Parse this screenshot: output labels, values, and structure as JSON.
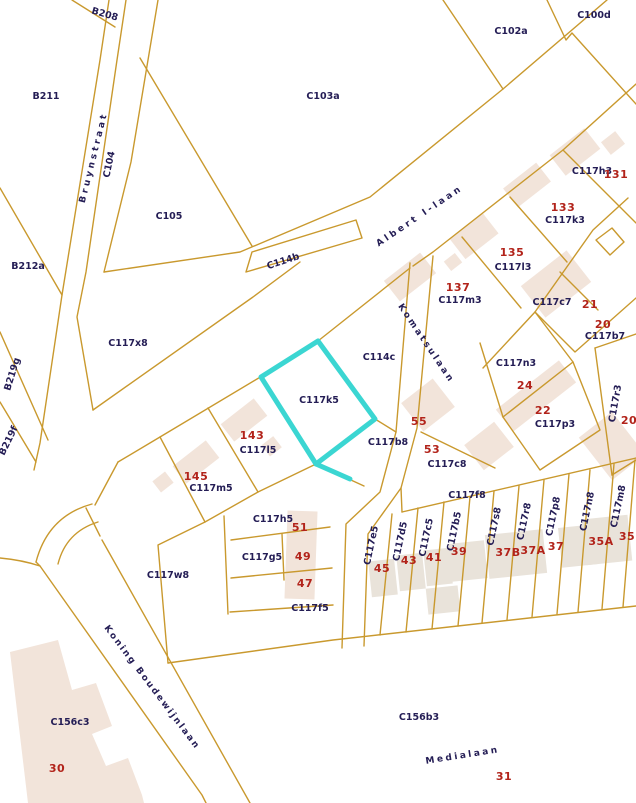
{
  "map": {
    "background": "#ffffff",
    "boundary_color": "#c9992e",
    "building_color": "#f2e4da",
    "parcel_text_color": "#241d55",
    "house_number_color": "#b2231a",
    "highlight": {
      "parcel_code": "C117k5",
      "color": "#3bd6d2"
    },
    "streets": [
      {
        "name": "Bruynstraat",
        "x": 96,
        "y": 158,
        "rot": -76,
        "ls": 3
      },
      {
        "name": "Albert I-laan",
        "x": 421,
        "y": 218,
        "rot": -34,
        "ls": 3
      },
      {
        "name": "Komatsulaan",
        "x": 424,
        "y": 345,
        "rot": 56,
        "ls": 2.5
      },
      {
        "name": "Koning Boudewijnlaan",
        "x": 150,
        "y": 689,
        "rot": 53,
        "ls": 2
      },
      {
        "name": "Medialaan",
        "x": 463,
        "y": 758,
        "rot": -9,
        "ls": 2.5
      }
    ],
    "parcels": [
      {
        "code": "B208",
        "x": 104,
        "y": 17,
        "rot": 16
      },
      {
        "code": "B211",
        "x": 46,
        "y": 99
      },
      {
        "code": "B212a",
        "x": 28,
        "y": 269
      },
      {
        "code": "B219g",
        "x": 15,
        "y": 375,
        "rot": -73
      },
      {
        "code": "B219f",
        "x": 11,
        "y": 442,
        "rot": -64
      },
      {
        "code": "C104",
        "x": 112,
        "y": 165,
        "rot": -78
      },
      {
        "code": "C105",
        "x": 169,
        "y": 219
      },
      {
        "code": "C103a",
        "x": 323,
        "y": 99
      },
      {
        "code": "C102a",
        "x": 511,
        "y": 34
      },
      {
        "code": "C100d",
        "x": 594,
        "y": 18
      },
      {
        "code": "C114b",
        "x": 284,
        "y": 264,
        "rot": -18
      },
      {
        "code": "C117x8",
        "x": 128,
        "y": 346
      },
      {
        "code": "C114c",
        "x": 379,
        "y": 360
      },
      {
        "code": "C117k5",
        "x": 319,
        "y": 403
      },
      {
        "code": "C117b8",
        "x": 388,
        "y": 445
      },
      {
        "code": "C117h3",
        "x": 592,
        "y": 174
      },
      {
        "code": "C117k3",
        "x": 565,
        "y": 223
      },
      {
        "code": "C117l3",
        "x": 513,
        "y": 270
      },
      {
        "code": "C117m3",
        "x": 460,
        "y": 303
      },
      {
        "code": "C117c7",
        "x": 552,
        "y": 305
      },
      {
        "code": "C117b7",
        "x": 605,
        "y": 339
      },
      {
        "code": "C117n3",
        "x": 516,
        "y": 366
      },
      {
        "code": "C117p3",
        "x": 555,
        "y": 427
      },
      {
        "code": "C117r3",
        "x": 618,
        "y": 404,
        "rot": -80
      },
      {
        "code": "C117l5",
        "x": 258,
        "y": 453
      },
      {
        "code": "C117m5",
        "x": 211,
        "y": 491
      },
      {
        "code": "C117c8",
        "x": 447,
        "y": 467
      },
      {
        "code": "C117f8",
        "x": 467,
        "y": 498
      },
      {
        "code": "C117h5",
        "x": 273,
        "y": 522
      },
      {
        "code": "C117g5",
        "x": 262,
        "y": 560
      },
      {
        "code": "C117f5",
        "x": 310,
        "y": 611
      },
      {
        "code": "C117w8",
        "x": 168,
        "y": 578
      },
      {
        "code": "C156c3",
        "x": 70,
        "y": 725
      },
      {
        "code": "C156b3",
        "x": 419,
        "y": 720
      },
      {
        "code": "C117e5",
        "x": 374,
        "y": 546,
        "rot": -78
      },
      {
        "code": "C117d5",
        "x": 403,
        "y": 542,
        "rot": -78
      },
      {
        "code": "C117c5",
        "x": 429,
        "y": 538,
        "rot": -78
      },
      {
        "code": "C117b5",
        "x": 457,
        "y": 532,
        "rot": -78
      },
      {
        "code": "C117s8",
        "x": 497,
        "y": 527,
        "rot": -78
      },
      {
        "code": "C117r8",
        "x": 527,
        "y": 522,
        "rot": -78
      },
      {
        "code": "C117p8",
        "x": 556,
        "y": 517,
        "rot": -78
      },
      {
        "code": "C117n8",
        "x": 590,
        "y": 512,
        "rot": -78
      },
      {
        "code": "C117m8",
        "x": 621,
        "y": 507,
        "rot": -78
      }
    ],
    "house_numbers": [
      {
        "n": "131",
        "x": 616,
        "y": 178
      },
      {
        "n": "133",
        "x": 563,
        "y": 211
      },
      {
        "n": "135",
        "x": 512,
        "y": 256
      },
      {
        "n": "137",
        "x": 458,
        "y": 291
      },
      {
        "n": "21",
        "x": 590,
        "y": 308
      },
      {
        "n": "20",
        "x": 603,
        "y": 328
      },
      {
        "n": "24",
        "x": 525,
        "y": 389
      },
      {
        "n": "22",
        "x": 543,
        "y": 414
      },
      {
        "n": "20",
        "x": 629,
        "y": 424
      },
      {
        "n": "55",
        "x": 419,
        "y": 425
      },
      {
        "n": "53",
        "x": 432,
        "y": 453
      },
      {
        "n": "143",
        "x": 252,
        "y": 439
      },
      {
        "n": "145",
        "x": 196,
        "y": 480
      },
      {
        "n": "51",
        "x": 300,
        "y": 531
      },
      {
        "n": "49",
        "x": 303,
        "y": 560
      },
      {
        "n": "47",
        "x": 305,
        "y": 587
      },
      {
        "n": "45",
        "x": 382,
        "y": 572
      },
      {
        "n": "43",
        "x": 409,
        "y": 564
      },
      {
        "n": "41",
        "x": 434,
        "y": 561
      },
      {
        "n": "39",
        "x": 459,
        "y": 555
      },
      {
        "n": "37B",
        "x": 508,
        "y": 556
      },
      {
        "n": "37A",
        "x": 533,
        "y": 554
      },
      {
        "n": "37",
        "x": 556,
        "y": 550
      },
      {
        "n": "35A",
        "x": 601,
        "y": 545
      },
      {
        "n": "35",
        "x": 627,
        "y": 540
      },
      {
        "n": "30",
        "x": 57,
        "y": 772
      },
      {
        "n": "31",
        "x": 504,
        "y": 780
      }
    ]
  }
}
